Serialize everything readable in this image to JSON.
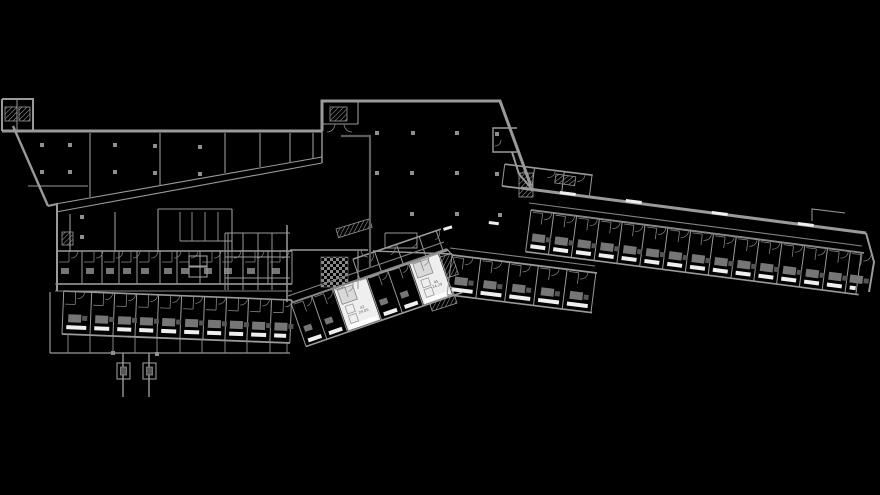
{
  "meta": {
    "title": "CAD floor plan drawing",
    "background": "black canvas, no visible UI chrome"
  },
  "colors": {
    "bg": "#000000",
    "wall": "#9a9a9a",
    "wall_dim": "#848484",
    "dark": "#5d5d5d",
    "furn": "#767676",
    "furn_dark": "#555555",
    "white": "#efefef",
    "column": "#8f8f8f",
    "label": "#5a5a5a"
  },
  "labels": {
    "room_a": {
      "no": "42",
      "area": "24.05"
    },
    "room_b": {
      "no": "45",
      "area": "24.29"
    }
  },
  "plan": {
    "walls": [
      {
        "p": [
          [
            2,
            99
          ],
          [
            33,
            99
          ],
          [
            33,
            131
          ]
        ],
        "w": 2
      },
      {
        "p": [
          [
            2,
            99
          ],
          [
            2,
            131
          ]
        ],
        "w": 2
      },
      {
        "p": [
          [
            17,
            99
          ],
          [
            17,
            131
          ]
        ],
        "w": 1
      },
      {
        "p": [
          [
            2,
            131
          ],
          [
            322,
            131
          ]
        ],
        "w": 3
      },
      {
        "p": [
          [
            322,
            131
          ],
          [
            322,
            101
          ],
          [
            500,
            101
          ],
          [
            531,
            186
          ]
        ],
        "w": 3
      },
      {
        "p": [
          [
            13,
            126
          ],
          [
            48,
            206
          ]
        ],
        "w": 2.4
      },
      {
        "p": [
          [
            48,
            206
          ],
          [
            57,
            204
          ],
          [
            57,
            291
          ]
        ],
        "w": 2
      },
      {
        "p": [
          [
            28,
            186
          ],
          [
            88,
            186
          ]
        ],
        "w": 1.1
      },
      {
        "p": [
          [
            90,
            133
          ],
          [
            90,
            197
          ]
        ],
        "w": 1.1
      },
      {
        "p": [
          [
            160,
            133
          ],
          [
            160,
            185
          ]
        ],
        "w": 1.1
      },
      {
        "p": [
          [
            225,
            133
          ],
          [
            225,
            173
          ]
        ],
        "w": 1.1
      },
      {
        "p": [
          [
            260,
            133
          ],
          [
            260,
            167
          ]
        ],
        "w": 1.1
      },
      {
        "p": [
          [
            290,
            133
          ],
          [
            290,
            162
          ]
        ],
        "w": 1.1
      },
      {
        "p": [
          [
            313,
            133
          ],
          [
            313,
            158
          ]
        ],
        "w": 1.1
      },
      {
        "p": [
          [
            322,
            131
          ],
          [
            322,
            163
          ]
        ],
        "w": 1.4
      },
      {
        "p": [
          [
            50,
            205
          ],
          [
            322,
            157
          ]
        ],
        "w": 1.1
      },
      {
        "p": [
          [
            56,
            212
          ],
          [
            322,
            163
          ]
        ],
        "w": 1.1
      },
      {
        "p": [
          [
            70,
            214
          ],
          [
            70,
            252
          ]
        ],
        "w": 1.1
      },
      {
        "p": [
          [
            115,
            212
          ],
          [
            115,
            252
          ]
        ],
        "w": 1.1
      },
      {
        "p": [
          [
            158,
            209
          ],
          [
            158,
            252
          ]
        ],
        "w": 1.1
      },
      {
        "p": [
          [
            158,
            209
          ],
          [
            232,
            209
          ]
        ],
        "w": 1.1
      },
      {
        "p": [
          [
            180,
            212
          ],
          [
            180,
            241
          ]
        ],
        "w": 0.9
      },
      {
        "p": [
          [
            192,
            212
          ],
          [
            192,
            241
          ]
        ],
        "w": 0.9
      },
      {
        "p": [
          [
            205,
            212
          ],
          [
            205,
            241
          ]
        ],
        "w": 0.9
      },
      {
        "p": [
          [
            218,
            212
          ],
          [
            218,
            241
          ]
        ],
        "w": 0.9
      },
      {
        "p": [
          [
            232,
            209
          ],
          [
            232,
            252
          ]
        ],
        "w": 1.1
      },
      {
        "p": [
          [
            180,
            241
          ],
          [
            232,
            241
          ]
        ],
        "w": 0.9
      },
      {
        "p": [
          [
            225,
            233
          ],
          [
            290,
            233
          ]
        ],
        "w": 1
      },
      {
        "p": [
          [
            225,
            257
          ],
          [
            290,
            257
          ]
        ],
        "w": 1
      },
      {
        "p": [
          [
            225,
            278
          ],
          [
            290,
            278
          ]
        ],
        "w": 1
      },
      {
        "p": [
          [
            225,
            233
          ],
          [
            225,
            290
          ]
        ],
        "w": 1
      },
      {
        "p": [
          [
            228,
            233
          ],
          [
            228,
            290
          ]
        ],
        "w": 1
      },
      {
        "p": [
          [
            243,
            233
          ],
          [
            243,
            290
          ]
        ],
        "w": 1
      },
      {
        "p": [
          [
            258,
            233
          ],
          [
            258,
            290
          ]
        ],
        "w": 1
      },
      {
        "p": [
          [
            272,
            233
          ],
          [
            272,
            290
          ]
        ],
        "w": 1
      },
      {
        "p": [
          [
            287,
            225
          ],
          [
            287,
            302
          ]
        ],
        "w": 1.5
      },
      {
        "p": [
          [
            290,
            250
          ],
          [
            368,
            250
          ]
        ],
        "w": 1.4
      },
      {
        "p": [
          [
            373,
            251
          ],
          [
            452,
            254
          ]
        ],
        "w": 1.4
      },
      {
        "p": [
          [
            358,
            251
          ],
          [
            358,
            289
          ]
        ],
        "w": 1.1
      },
      {
        "p": [
          [
            385,
            233
          ],
          [
            417,
            233
          ],
          [
            417,
            248
          ],
          [
            385,
            248
          ],
          [
            385,
            233
          ]
        ],
        "w": 0.9
      },
      {
        "p": [
          [
            517,
            128
          ],
          [
            493,
            128
          ],
          [
            493,
            152
          ],
          [
            517,
            152
          ]
        ],
        "w": 1.4
      },
      {
        "p": [
          [
            512,
            152
          ],
          [
            519,
            174
          ],
          [
            531,
            188
          ]
        ],
        "w": 2
      },
      {
        "p": [
          [
            521,
            188
          ],
          [
            866,
            233
          ]
        ],
        "w": 3
      },
      {
        "p": [
          [
            866,
            233
          ],
          [
            874,
            262
          ],
          [
            869,
            292
          ]
        ],
        "w": 2
      },
      {
        "p": [
          [
            812,
            221
          ],
          [
            812,
            209
          ],
          [
            845,
            213
          ]
        ],
        "w": 1
      },
      {
        "p": [
          [
            322,
            124
          ],
          [
            358,
            124
          ]
        ],
        "w": 1.1
      },
      {
        "p": [
          [
            358,
            101
          ],
          [
            358,
            124
          ]
        ],
        "w": 1.1
      },
      {
        "p": [
          [
            57,
            250
          ],
          [
            57,
            291
          ]
        ],
        "w": 1.6
      },
      {
        "p": [
          [
            50,
            292
          ],
          [
            50,
            353
          ]
        ],
        "w": 1.2
      },
      {
        "p": [
          [
            50,
            353
          ],
          [
            290,
            353
          ]
        ],
        "w": 1.3
      },
      {
        "p": [
          [
            447,
            249
          ],
          [
            452,
            255
          ]
        ],
        "w": 1.2
      }
    ],
    "corridors": [
      {
        "p": [
          [
            55,
            284
          ],
          [
            292,
            284
          ]
        ]
      },
      {
        "p": [
          [
            55,
            291
          ],
          [
            292,
            291
          ]
        ]
      },
      {
        "p": [
          [
            288,
            296
          ],
          [
            444,
            242
          ]
        ]
      },
      {
        "p": [
          [
            291,
            303
          ],
          [
            447,
            249
          ]
        ]
      },
      {
        "p": [
          [
            529,
            203
          ],
          [
            862,
            246
          ]
        ]
      },
      {
        "p": [
          [
            531,
            210
          ],
          [
            864,
            253
          ]
        ]
      },
      {
        "p": [
          [
            450,
            248
          ],
          [
            595,
            266
          ]
        ]
      }
    ],
    "terrace_ticks": [
      [
        68,
        334
      ],
      [
        90,
        335
      ],
      [
        113,
        336
      ],
      [
        135,
        337
      ],
      [
        157,
        338
      ],
      [
        180,
        339
      ],
      [
        202,
        339
      ],
      [
        225,
        340
      ],
      [
        247,
        341
      ],
      [
        270,
        342
      ],
      [
        287,
        343
      ]
    ],
    "stilts": [
      {
        "x": 123,
        "y1": 353,
        "y2": 397
      },
      {
        "x": 149,
        "y1": 353,
        "y2": 397
      }
    ],
    "footings": [
      {
        "x": 117,
        "y": 363,
        "w": 13,
        "h": 16
      },
      {
        "x": 143,
        "y": 363,
        "w": 13,
        "h": 16
      }
    ],
    "dark_lines": [
      {
        "p": [
          [
            341,
            136
          ],
          [
            370,
            136
          ],
          [
            370,
            268
          ]
        ],
        "w": 2.2
      }
    ],
    "columns": [
      [
        377,
        133
      ],
      [
        413,
        133
      ],
      [
        457,
        133
      ],
      [
        497,
        134
      ],
      [
        377,
        173
      ],
      [
        412,
        173
      ],
      [
        457,
        173
      ],
      [
        497,
        174
      ],
      [
        412,
        214
      ],
      [
        457,
        214
      ],
      [
        500,
        215
      ],
      [
        42,
        145
      ],
      [
        70,
        145
      ],
      [
        115,
        145
      ],
      [
        155,
        146
      ],
      [
        200,
        147
      ],
      [
        42,
        172
      ],
      [
        70,
        172
      ],
      [
        115,
        172
      ],
      [
        155,
        173
      ],
      [
        200,
        174
      ],
      [
        82,
        217
      ],
      [
        82,
        237
      ],
      [
        113,
        353
      ],
      [
        157,
        354
      ]
    ],
    "hatches": [
      {
        "x": 5,
        "y": 107,
        "w": 12,
        "h": 14,
        "r": 0
      },
      {
        "x": 19,
        "y": 107,
        "w": 11,
        "h": 14,
        "r": 0
      },
      {
        "x": 330,
        "y": 107,
        "w": 17,
        "h": 14,
        "r": 0
      },
      {
        "x": 62,
        "y": 232,
        "w": 11,
        "h": 13,
        "r": 0
      },
      {
        "x": 519,
        "y": 173,
        "w": 14,
        "h": 24,
        "r": 0
      },
      {
        "x": 556,
        "y": 174,
        "w": 20,
        "h": 9,
        "r": 8
      },
      {
        "x": 336,
        "y": 229,
        "w": 35,
        "h": 9,
        "r": -17
      },
      {
        "x": 425,
        "y": 262,
        "w": 28,
        "h": 22,
        "r": -18
      },
      {
        "x": 427,
        "y": 295,
        "w": 26,
        "h": 17,
        "r": -18
      }
    ],
    "checker": {
      "x": 321,
      "y": 257,
      "w": 27,
      "h": 30
    },
    "elevator": [
      {
        "x": 189,
        "y": 256,
        "w": 18,
        "h": 10
      },
      {
        "x": 189,
        "y": 267,
        "w": 18,
        "h": 10
      }
    ],
    "window_dashes": [
      {
        "x": 560,
        "y": 191,
        "len": 16,
        "r": 7.4
      },
      {
        "x": 626,
        "y": 199,
        "len": 16,
        "r": 7.4
      },
      {
        "x": 712,
        "y": 211,
        "len": 16,
        "r": 7.4
      },
      {
        "x": 798,
        "y": 222,
        "len": 16,
        "r": 7.4
      },
      {
        "x": 443,
        "y": 228,
        "len": 9,
        "r": -17
      },
      {
        "x": 489,
        "y": 221,
        "len": 10,
        "r": 7
      }
    ],
    "arcs_extra": [
      {
        "h": [
          327,
          124
        ],
        "r": 8,
        "sx": 1,
        "sy": 1,
        "f": 1
      },
      {
        "h": [
          352,
          124
        ],
        "r": 8,
        "sx": -1,
        "sy": 1,
        "f": 0
      },
      {
        "h": [
          495,
          140
        ],
        "r": 6,
        "sx": 1,
        "sy": 1,
        "f": 1
      },
      {
        "h": [
          368,
          250
        ],
        "r": 7,
        "sx": -1,
        "sy": 1,
        "f": 0
      }
    ],
    "wings": [
      {
        "name": "south-west-rooms",
        "a": [
          62,
          334
        ],
        "b": [
          290,
          343
        ],
        "side": -1,
        "depth": 43,
        "divs": [
          0,
          28,
          51,
          73,
          95,
          118,
          141,
          163,
          185,
          208,
          228
        ],
        "win": [
          5,
          9
        ],
        "furn": "double",
        "furnD": 12,
        "pod": [
          30,
          43
        ],
        "door": 43,
        "doorIn": -1
      },
      {
        "name": "west-upper-rooms",
        "a": [
          57,
          284
        ],
        "b": [
          292,
          284
        ],
        "side": -1,
        "depth": 33,
        "divs": [
          0,
          25,
          45,
          62,
          80,
          103,
          120,
          143,
          163,
          186,
          211,
          235
        ],
        "furn": "small",
        "furnD": 10,
        "pod": [
          22,
          33
        ],
        "door": 33,
        "doorIn": -1
      },
      {
        "name": "middle-wing-rooms",
        "a": [
          291,
          303
        ],
        "b": [
          447,
          249
        ],
        "side": 1,
        "depth": 46,
        "divs": [
          0,
          22,
          44,
          80,
          102,
          124,
          156
        ],
        "win": [
          39,
          43
        ],
        "furn": "small",
        "furnD": 26,
        "pod": [
          2,
          13
        ],
        "door": 1,
        "doorIn": 1,
        "white": [
          2,
          5
        ],
        "labelKeys": [
          "room_a",
          "room_b"
        ]
      },
      {
        "name": "east-wing-rooms",
        "a": [
          531,
          210
        ],
        "b": [
          864,
          253
        ],
        "side": 1,
        "depth": 42,
        "divs": [
          0,
          23,
          46,
          69,
          92,
          115,
          138,
          161,
          184,
          207,
          230,
          253,
          276,
          299,
          322,
          333
        ],
        "win": [
          34,
          38
        ],
        "furn": "double",
        "furnD": 23,
        "pod": [
          2,
          13
        ],
        "door": 1,
        "doorIn": 1
      },
      {
        "name": "east-wing-lower-rooms",
        "a": [
          452,
          255
        ],
        "b": [
          597,
          273
        ],
        "side": 1,
        "depth": 40,
        "divs": [
          0,
          29,
          58,
          87,
          116,
          145
        ],
        "win": [
          32,
          36
        ],
        "furn": "double",
        "furnD": 21,
        "pod": [
          2,
          13
        ],
        "door": 1,
        "doorIn": 1
      },
      {
        "name": "middle-north-rooms",
        "a": [
          360,
          280
        ],
        "b": [
          448,
          250
        ],
        "side": -1,
        "depth": 22,
        "divs": [
          0,
          23,
          46,
          70,
          88
        ],
        "door": 21,
        "doorIn": -1
      },
      {
        "name": "hall-edge-rooms",
        "a": [
          502,
          186
        ],
        "b": [
          590,
          197
        ],
        "side": -1,
        "depth": 22,
        "divs": [
          0,
          30,
          60,
          88
        ],
        "door": 21,
        "doorIn": -1
      }
    ]
  }
}
